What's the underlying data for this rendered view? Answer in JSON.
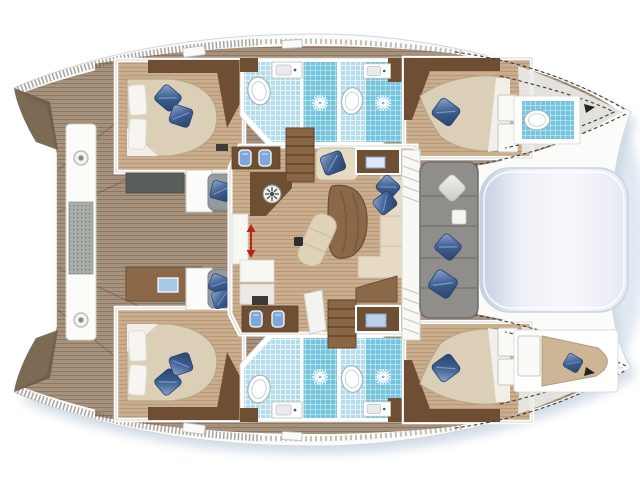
{
  "page": {
    "title": "Catamaran deck / accommodation floor plan",
    "view": "top-down naval architecture drawing, bows pointing right, no text labels"
  },
  "palette": {
    "background": "#ffffff",
    "hull_white": "#fbfbf9",
    "hull_outline": "#d3d6da",
    "shadow_blue": "#9db3cb",
    "deck_wood": "#a6917c",
    "floor_wood": "#c9ad8d",
    "dark_wood": "#6e4f33",
    "mid_wood": "#8a6848",
    "step_wood": "#8a6644",
    "mattress_cream": "#dccfb8",
    "mattress_edge": "#b6a687",
    "linen_white": "#f6f5f1",
    "cream_sofa": "#e6dac4",
    "pillow_blue": "#3c5e92",
    "pillow_blue_light": "#8fa9cf",
    "tile_light": "#b3dcec",
    "tile_dark": "#74c4de",
    "sofa_gray": "#8f8e8a",
    "sofa_gray_dark": "#6f6e6a",
    "seat_gray": "#949a9e",
    "stool_blue": "#7fa7d8",
    "trampoline_light": "#f2f4f8",
    "trampoline_shade": "#c3cee2",
    "accent_red": "#b3261a"
  },
  "plan": {
    "port_hull": [
      "aft double cabin with two blue pillows",
      "shower and WC compartments with shower-rose symbols",
      "forward double cabin",
      "bow WC compartment"
    ],
    "starboard_hull": [
      "aft double cabin with two blue pillows",
      "shower and WC compartments with shower-rose symbols",
      "forward double cabin",
      "forepeak berth with blue cushion"
    ],
    "center": [
      "saloon with galley, vent fan, chart desks and stools",
      "dinette table with chaise and cream L-sofa",
      "companionway steps port and starboard",
      "sliding-door red arrow marker",
      "gray cockpit bench with three cushions",
      "bow lounge pad / trampoline between hulls",
      "aft crossbeam bench with two winches"
    ]
  },
  "features": [
    "boat-silhouette",
    "aft-deck",
    "crossbeam-bench",
    "winch-icon",
    "port-aft-cabin",
    "starboard-aft-cabin",
    "port-head-block",
    "starboard-head-block",
    "shower-icon",
    "toilet-icon",
    "sink-counter",
    "port-forward-cabin",
    "starboard-forward-cabin",
    "bow-head",
    "forepeak-berth",
    "saloon",
    "galley",
    "vent-fan-icon",
    "sliding-door-arrow",
    "companionway-steps",
    "dinette-table",
    "chaise-lounge",
    "saloon-sofa",
    "chart-desk",
    "vanity-stools",
    "cockpit-sofa",
    "blue-pillow",
    "white-pillow",
    "trampoline-pad",
    "lifeline-dashes"
  ]
}
